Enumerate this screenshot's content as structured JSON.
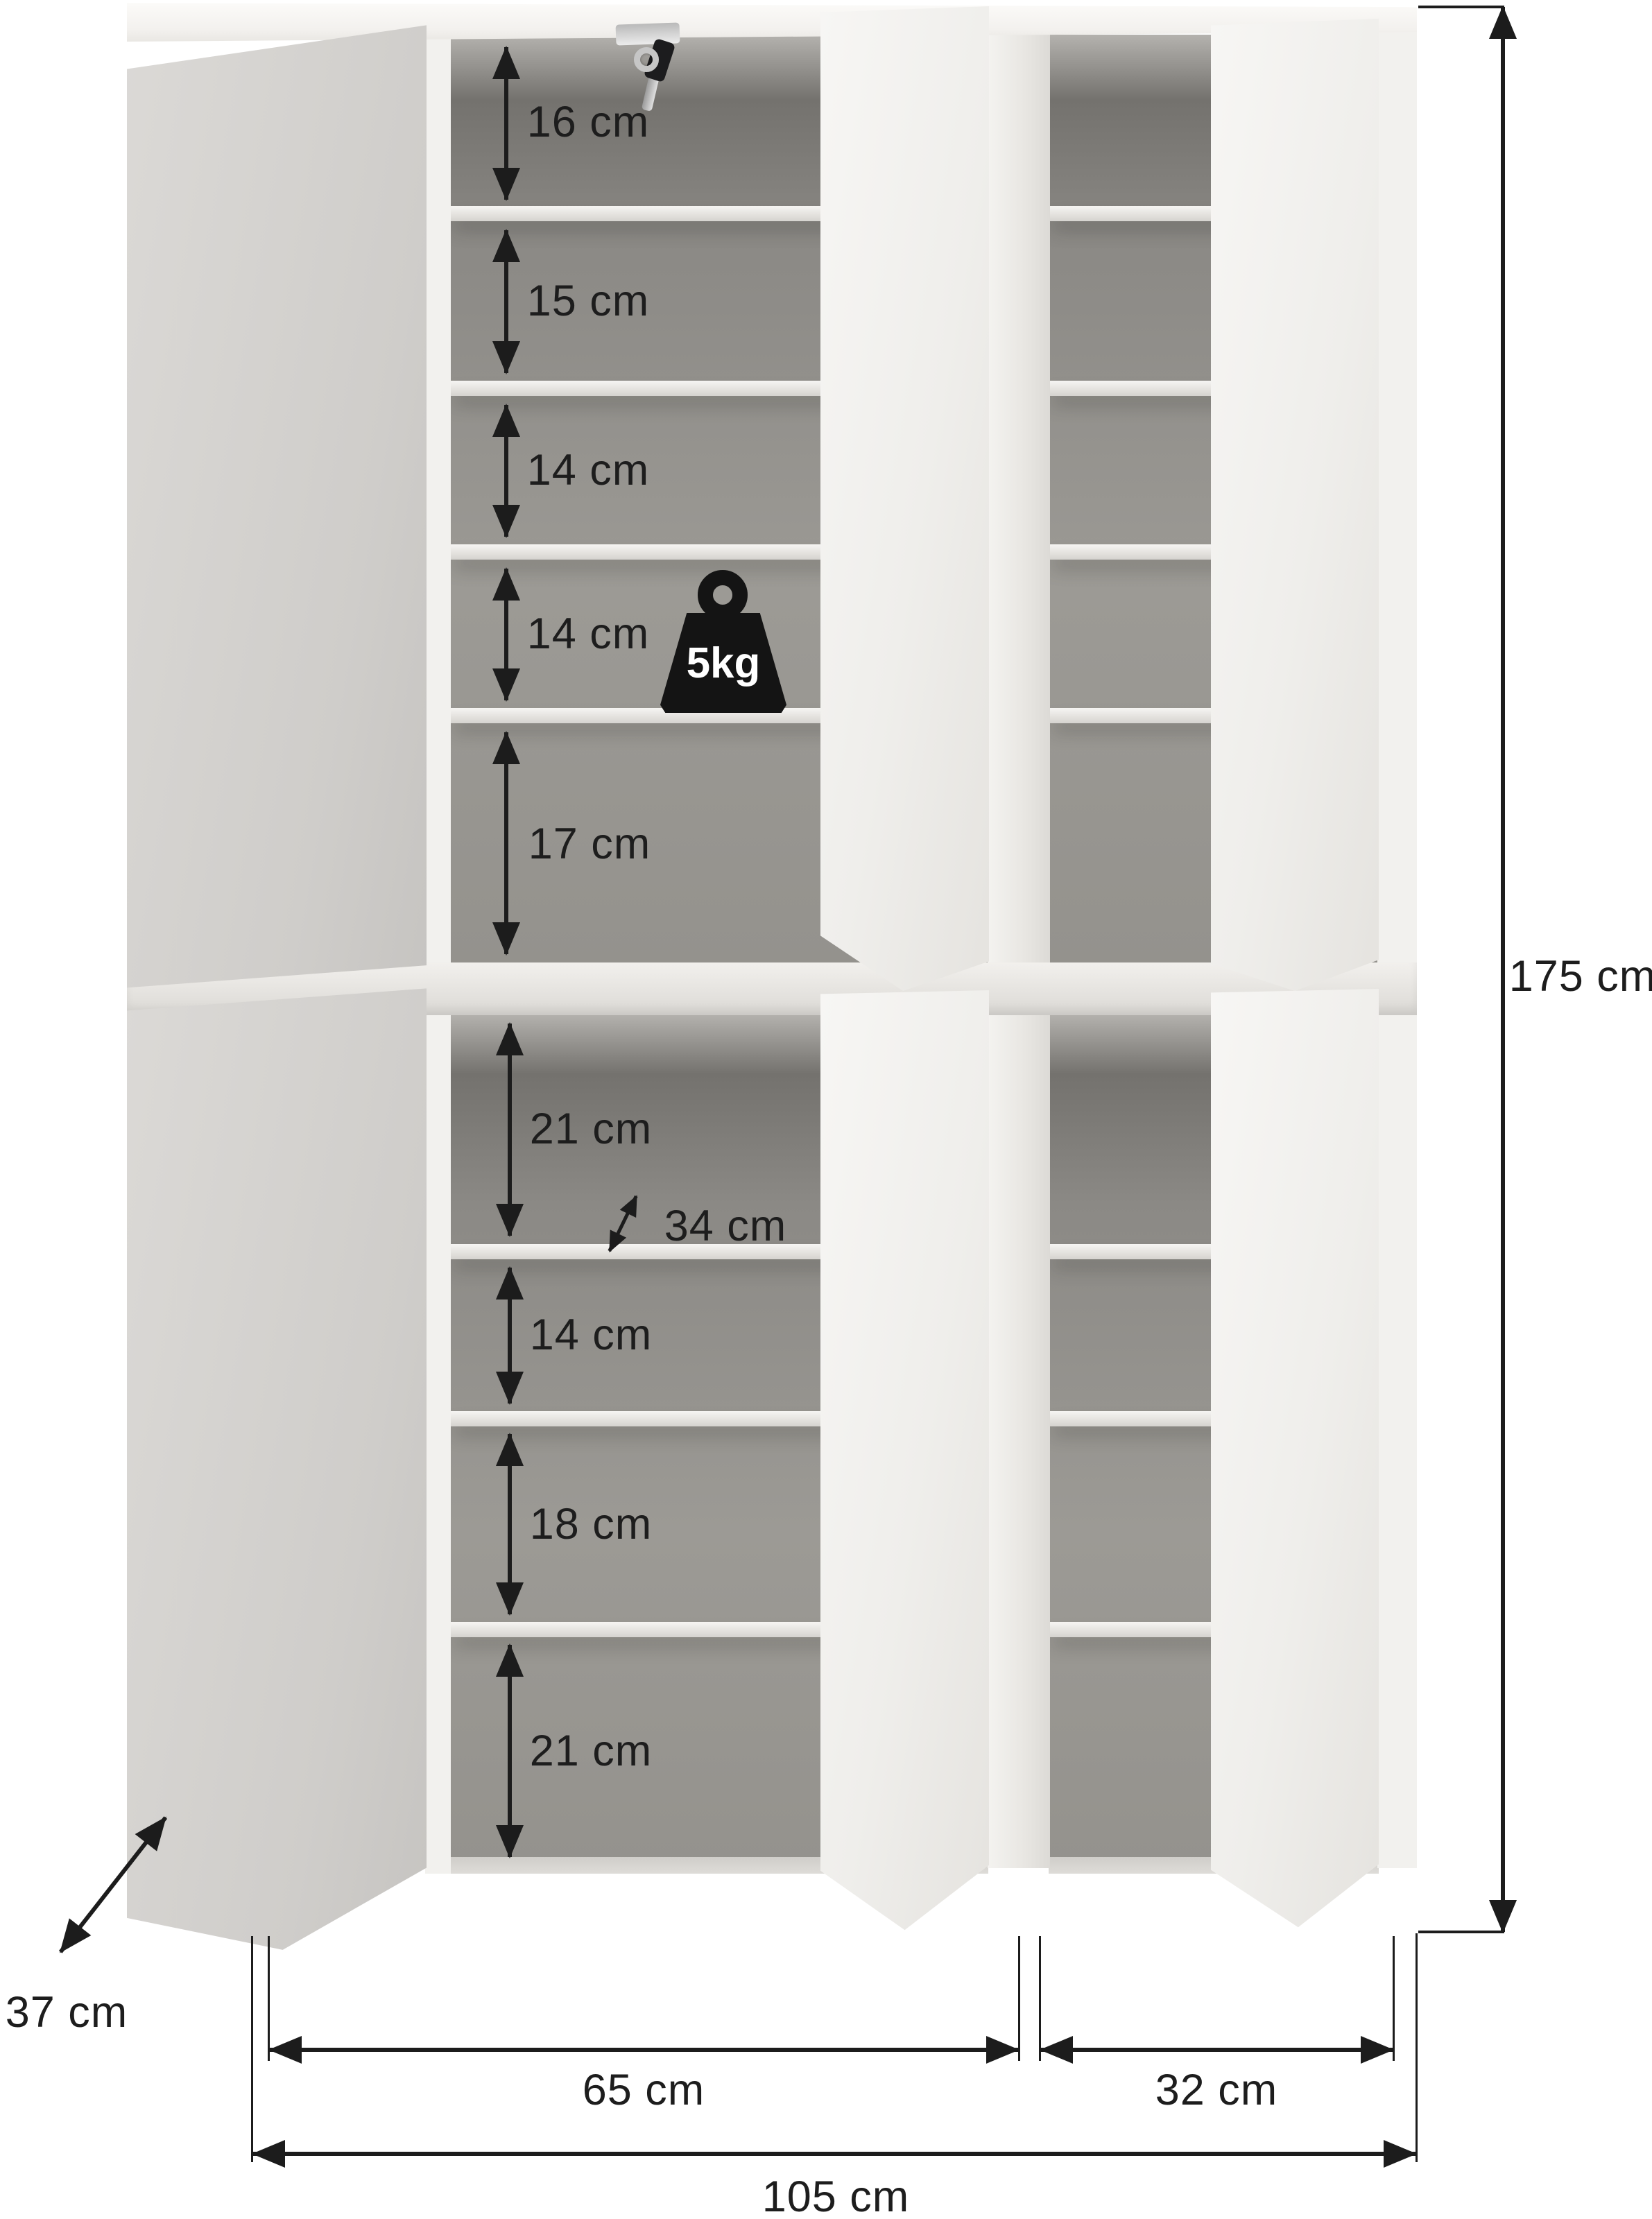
{
  "diagram_type": "furniture dimension drawing",
  "product": "two-column shoe cabinet with open doors and shelves",
  "dimensions": {
    "total_height": "175 cm",
    "total_width": "105 cm",
    "depth": "37 cm",
    "left_width": "65 cm",
    "right_width": "32 cm",
    "shelf_depth": "34 cm",
    "max_shelf_load": "5kg"
  },
  "upper_gaps": [
    "16 cm",
    "15 cm",
    "14 cm",
    "14 cm",
    "17 cm"
  ],
  "lower_gaps": [
    "21 cm",
    "14 cm",
    "18 cm",
    "21 cm"
  ],
  "colors": {
    "background": "#ffffff",
    "carcass_white": "#f2f1ee",
    "door_side_gray": "#d2d0cd",
    "interior_gray": "#94928d",
    "annotation_black": "#1c1c1c",
    "load_badge_black": "#141414"
  }
}
